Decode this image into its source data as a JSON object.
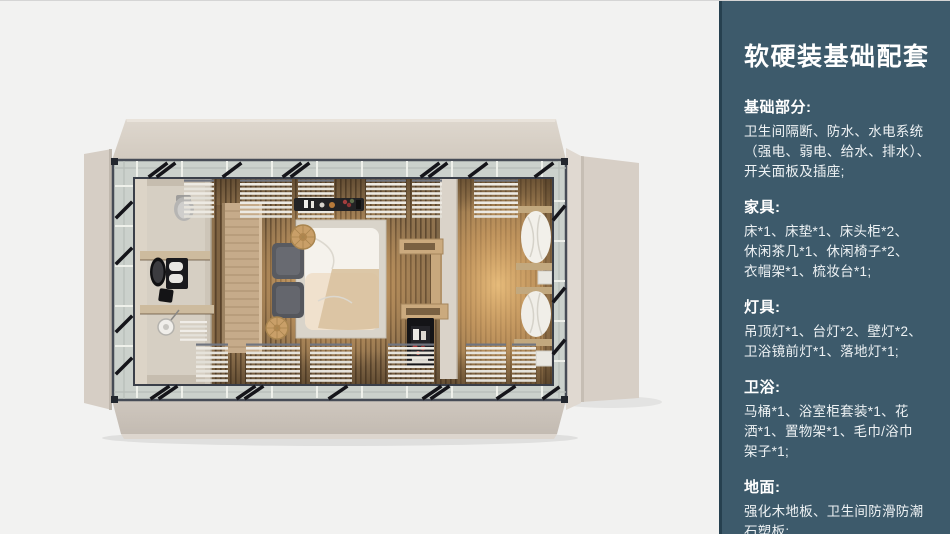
{
  "page": {
    "background": "#f2f2f1",
    "top_edge_line": "#d5d5d5"
  },
  "sidebar": {
    "background": "#3d5a6b",
    "edge_color": "#26404f",
    "title_color": "#ffffff",
    "body_color": "#eef2f4",
    "title": "软硬装基础配套",
    "sections": [
      {
        "heading": "基础部分:",
        "lines": [
          "卫生间隔断、防水、水电系统",
          "（强电、弱电、给水、排水）、",
          "开关面板及插座;"
        ]
      },
      {
        "heading": "家具:",
        "lines": [
          "床*1、床垫*1、床头柜*2、",
          "休闲茶几*1、休闲椅子*2、",
          "衣帽架*1、梳妆台*1;"
        ]
      },
      {
        "heading": "灯具:",
        "lines": [
          "吊顶灯*1、台灯*2、壁灯*2、",
          "卫浴镜前灯*1、落地灯*1;"
        ]
      },
      {
        "heading": "卫浴:",
        "lines": [
          "马桶*1、浴室柜套装*1、花",
          "洒*1、置物架*1、毛巾/浴巾",
          "架子*1;"
        ]
      },
      {
        "heading": "地面:",
        "lines": [
          "强化木地板、卫生间防滑防潮",
          "石塑板;"
        ]
      }
    ]
  },
  "render": {
    "colors": {
      "panel_beige": "#d8d0c7",
      "frame_steel": "#3a3f49",
      "glass_band": "#cbd1cc",
      "floor_wood": "#8f724e",
      "warm_glow": "#ffd189",
      "partition_wood": "#c6ab8a",
      "bed_duvet": "#f5f2ec",
      "fixture_black": "#141416"
    }
  }
}
